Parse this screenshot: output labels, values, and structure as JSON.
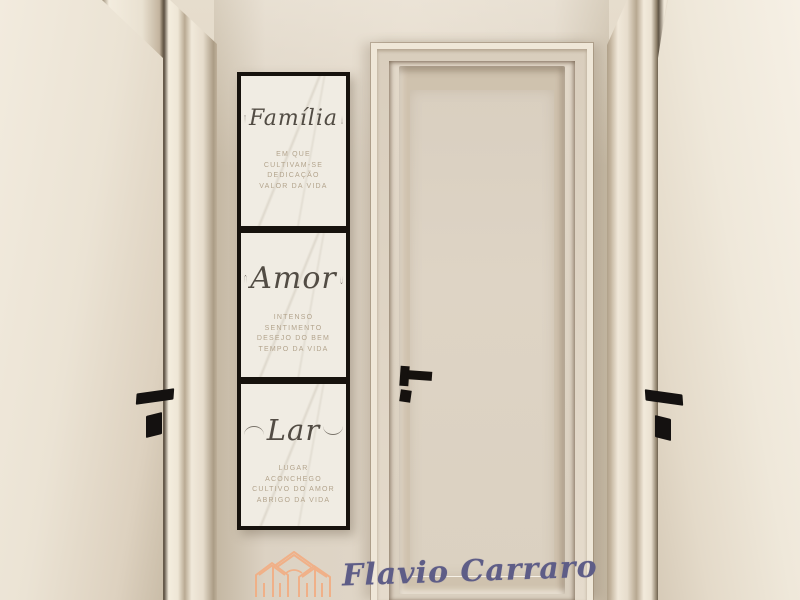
{
  "artwork": {
    "frame_color": "#16120d",
    "panel_color": "#f0ece3",
    "word_color": "#524c44",
    "caption_color": "#b3a48d",
    "panels": [
      {
        "word": "Família",
        "captions": [
          "EM QUE",
          "CULTIVAM-SE",
          "DEDICAÇÃO",
          "VALOR DA VIDA"
        ]
      },
      {
        "word": "Amor",
        "captions": [
          "INTENSO",
          "SENTIMENTO",
          "DESEJO DO BEM",
          "TEMPO DA VIDA"
        ]
      },
      {
        "word": "Lar",
        "captions": [
          "LUGAR",
          "ACONCHEGO",
          "CULTIVO DO AMOR",
          "ABRIGO DA VIDA"
        ]
      }
    ]
  },
  "watermark": {
    "name": "Flavio Carraro",
    "logo_icon": "house-outline-icon",
    "logo_color": "#f2ae83",
    "name_color": "#5e5d87"
  },
  "scene": {
    "wall_color": "#ddd3c3",
    "door_color": "#e9e1d2",
    "handle_color": "#141110"
  }
}
